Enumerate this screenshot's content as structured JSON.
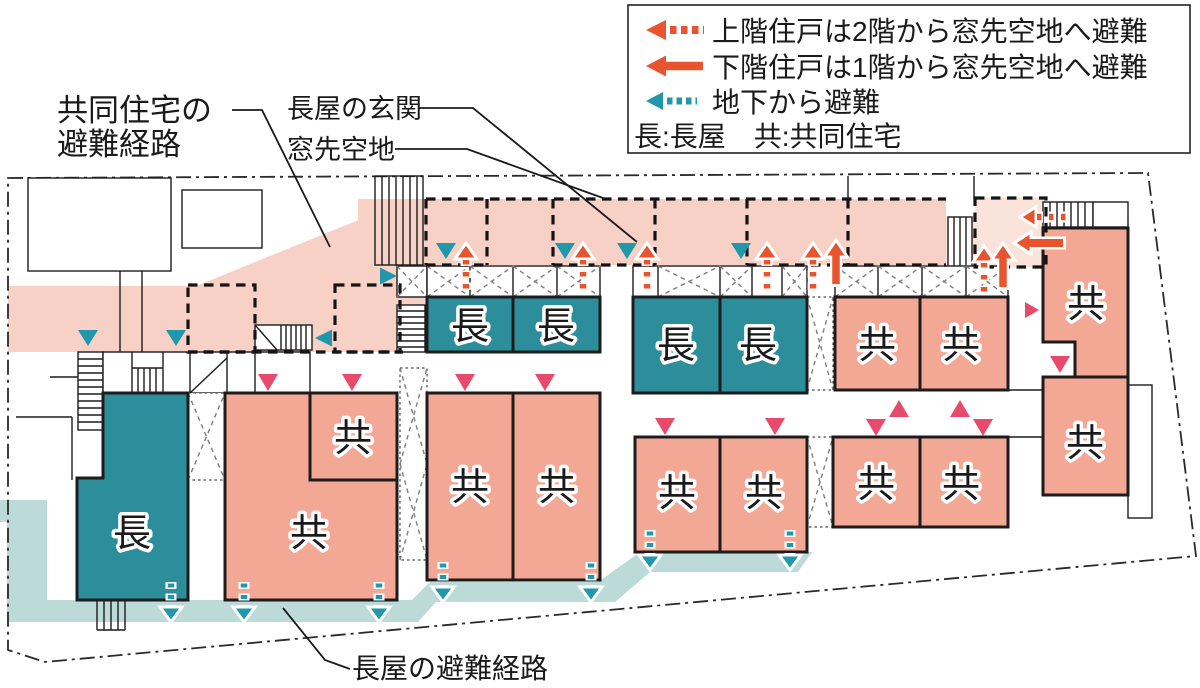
{
  "legend": {
    "items": [
      {
        "icon": "orange-dashed-left-arrow",
        "label": "上階住戸は2階から窓先空地へ避難"
      },
      {
        "icon": "orange-solid-left-arrow",
        "label": "下階住戸は1階から窓先空地へ避難"
      },
      {
        "icon": "teal-dashed-left-arrow",
        "label": "地下から避難"
      }
    ],
    "abbreviations": "長:長屋　共:共同住宅"
  },
  "annotations": {
    "apartment_route": {
      "line1": "共同住宅の",
      "line2": "避難経路"
    },
    "rowhouse_entrance": "長屋の玄関",
    "window_front_open_space": "窓先空地",
    "rowhouse_route": "長屋の避難経路"
  },
  "unit_labels": {
    "rowhouse": "長",
    "apartment": "共"
  },
  "colors": {
    "apartment_route_band": "#f7d1c5",
    "apartment_route_band_light": "#fae3da",
    "apartment_unit": "#f3a896",
    "rowhouse_unit": "#2b8e9a",
    "rowhouse_route_band": "#bcdad8",
    "evacuation_arrow_orange": "#e8542e",
    "entrance_arrow_rose": "#e84a6b",
    "basement_arrow_teal": "#2097ab"
  }
}
